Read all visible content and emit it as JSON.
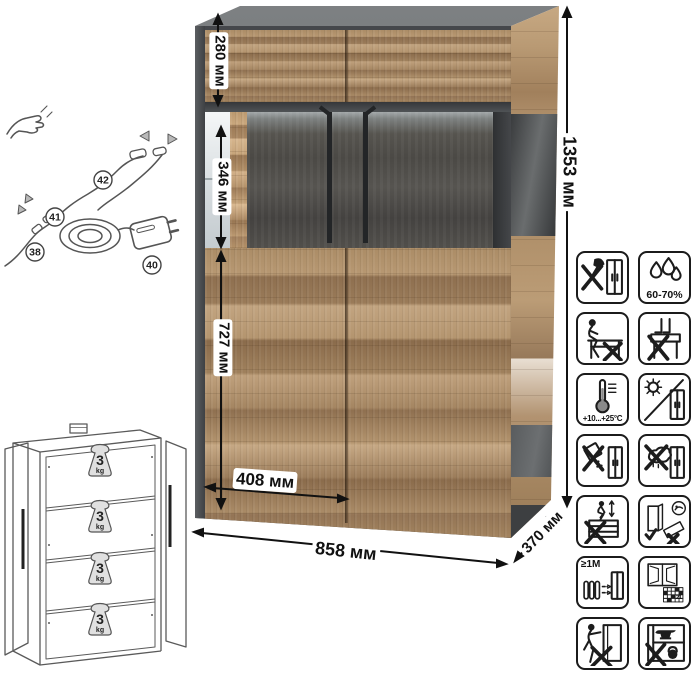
{
  "dimensions": {
    "overall_height": "1353 мм",
    "overall_width": "858 мм",
    "overall_depth": "370 мм",
    "top_section_height": "280 мм",
    "glass_section_height": "346 мм",
    "lower_section_height": "727 мм",
    "door_width": "408 мм"
  },
  "wiring_diagram": {
    "part_labels": [
      "38",
      "40",
      "41",
      "42"
    ]
  },
  "shelf_load_diagram": {
    "weight_value": "3",
    "weight_unit": "kg"
  },
  "care_icons": {
    "humidity_label": "60-70%",
    "temperature_label": "+10...+25°C",
    "distance_label": "≥1M",
    "calendar_day": "21",
    "names": [
      "no-sharp-tools",
      "humidity-range",
      "no-sitting",
      "no-standing",
      "temperature-range",
      "no-direct-sunlight",
      "no-spilling",
      "no-wet-cloth",
      "no-jumping",
      "transport-upright",
      "heat-source-distance",
      "ventilate-room",
      "no-dragging",
      "no-overloading"
    ]
  },
  "colors": {
    "wood": "#b2946f",
    "graphite": "#54565a",
    "glass_interior": "#4a4744",
    "handle": "#232527",
    "line_art": "#1c1c1c"
  }
}
